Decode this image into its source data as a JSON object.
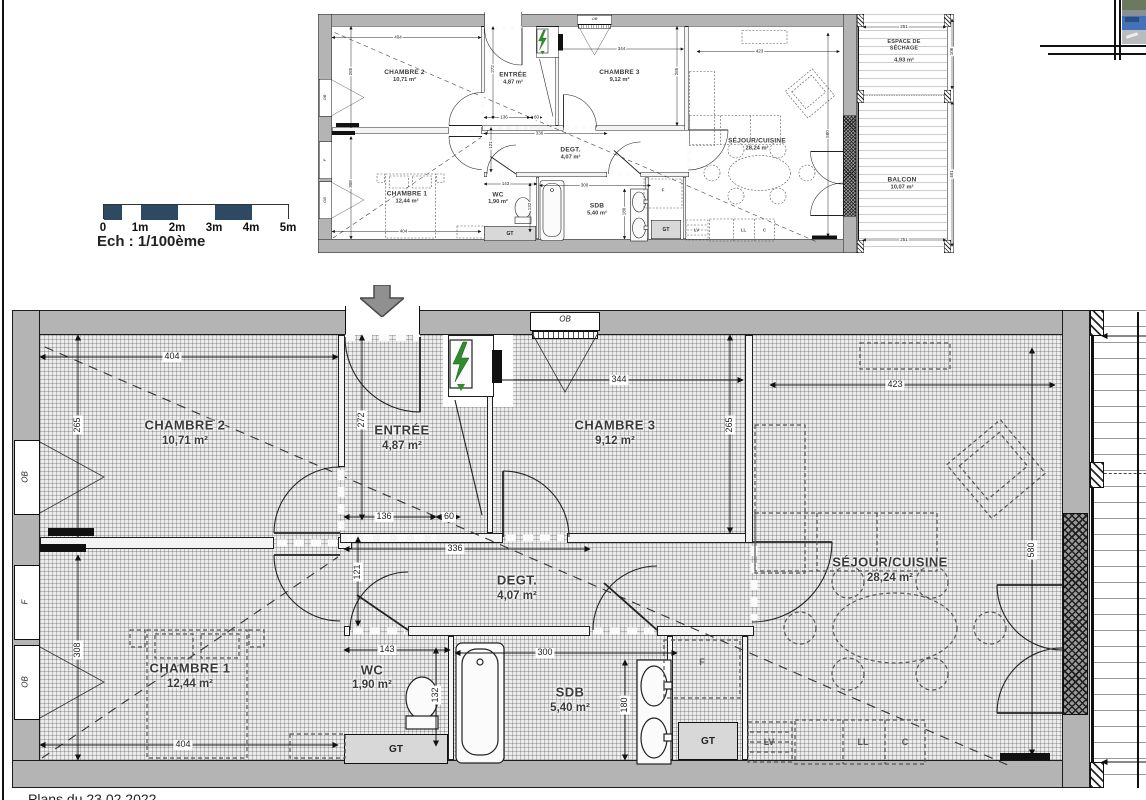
{
  "plan": {
    "rooms": {
      "chambre2": {
        "name": "CHAMBRE 2",
        "area": "10,71 m²"
      },
      "entree": {
        "name": "ENTRÉE",
        "area": "4,87 m²"
      },
      "chambre3": {
        "name": "CHAMBRE 3",
        "area": "9,12 m²"
      },
      "sejour": {
        "name": "SÉJOUR/CUISINE",
        "area": "28,24 m²"
      },
      "chambre1": {
        "name": "CHAMBRE 1",
        "area": "12,44 m²"
      },
      "wc": {
        "name": "WC",
        "area": "1,90 m²"
      },
      "degt": {
        "name": "DEGT.",
        "area": "4,07 m²"
      },
      "sdb": {
        "name": "SDB",
        "area": "5,40 m²"
      },
      "sechage": {
        "name": "ESPACE DE SÉCHAGE",
        "area": "4,93 m²"
      },
      "balcon": {
        "name": "BALCON",
        "area": "10,07 m²"
      }
    },
    "dims": {
      "w_ch2": "404",
      "h_ch2": "265",
      "h_entree": "272",
      "w_hall1": "136",
      "w_hall2": "60",
      "w_ch3": "344",
      "h_ch3": "265",
      "w_sejour": "423",
      "h_sejour": "580",
      "w_degt": "336",
      "h_degt": "121",
      "w_wc": "143",
      "h_wc": "132",
      "w_sdb": "300",
      "h_sdb": "180",
      "h_ch1": "308",
      "w_ch1": "404",
      "w_sechage": "251",
      "h_sechage": "106",
      "h_balcon": "401",
      "w_balcon": "251"
    },
    "tags": {
      "gt": "GT",
      "ob": "OB",
      "f_window": "F",
      "f_unit": "F",
      "lv": "LV",
      "ll": "LL",
      "c": "C"
    }
  },
  "scalebar": {
    "ticks": [
      "0",
      "1m",
      "2m",
      "3m",
      "4m",
      "5m"
    ],
    "label": "Ech : 1/100ème",
    "dark_color": "#2e4a63"
  },
  "caption": "Plans du 23.02.2022"
}
